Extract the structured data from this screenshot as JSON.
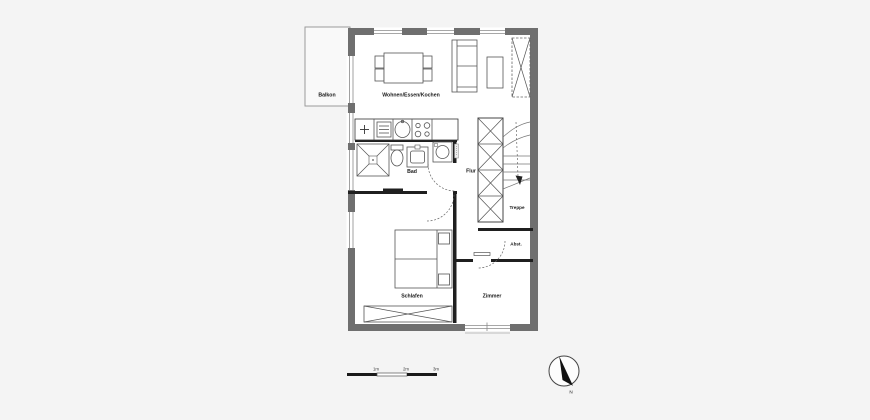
{
  "plan": {
    "rooms": {
      "balkon": "Balkon",
      "wohnen": "Wohnen/Essen/Kochen",
      "bad": "Bad",
      "flur": "Flur",
      "treppe": "Treppe",
      "abst": "Abst.",
      "schlafen": "Schlafen",
      "zimmer": "Zimmer"
    },
    "scale_bar": {
      "labels": [
        "1m",
        "2m",
        "3m"
      ]
    },
    "compass": {
      "north_label": "N"
    },
    "colors": {
      "background": "#f4f4f4",
      "wall": "#6f6f6f",
      "interior_wall": "#1f1f1f",
      "room_fill": "#ffffff"
    }
  }
}
